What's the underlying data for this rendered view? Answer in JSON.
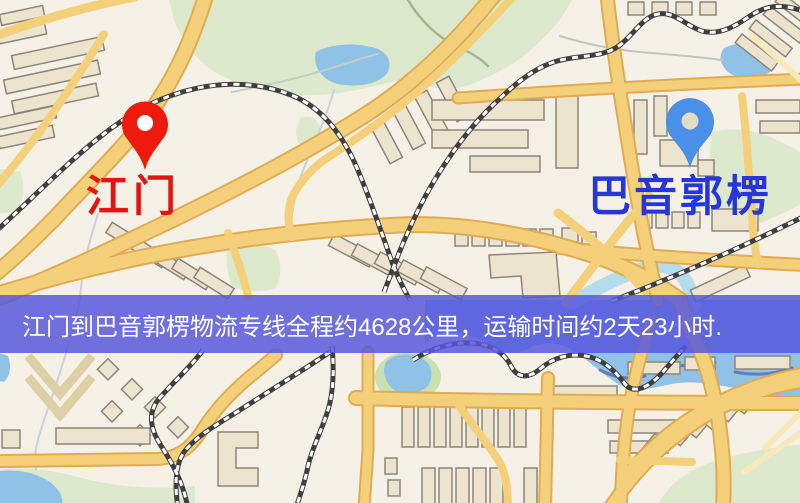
{
  "page": {
    "width": 800,
    "height": 503,
    "type": "logistics-route-map"
  },
  "banner": {
    "text": "江门到巴音郭楞物流专线全程约4628公里，运输时间约2天23小时.",
    "background_color": "#5656dc",
    "text_color": "#ffffff"
  },
  "route": {
    "origin": "江门",
    "destination": "巴音郭楞",
    "distance_km": "4628",
    "distance_text": "全程约4628公里",
    "duration_text": "运输时间约2天23小时"
  },
  "markers": {
    "origin": {
      "label": "江门",
      "label_color": "#e61410",
      "pin_color": "#ee1b0d",
      "pin_hole_color": "#ffffff",
      "icon": "red-map-pin-icon"
    },
    "destination": {
      "label": "巴音郭楞",
      "label_color": "#2636d8",
      "pin_color": "#4a90e8",
      "pin_hole_color": "#e3ddc6",
      "icon": "blue-map-pin-icon"
    }
  },
  "map": {
    "style": "street-map",
    "palette": {
      "background": "#f6f1e6",
      "road_fill": "#f4d07b",
      "road_casing": "#e0ab52",
      "minor_road": "#f8e9bd",
      "building_fill": "#ece4ce",
      "building_outline": "#8d8678",
      "green_area": "#dde9cd",
      "water": "#8fc2e6",
      "railway_dark": "#3f3f3f",
      "railway_light": "#ffffff"
    }
  }
}
